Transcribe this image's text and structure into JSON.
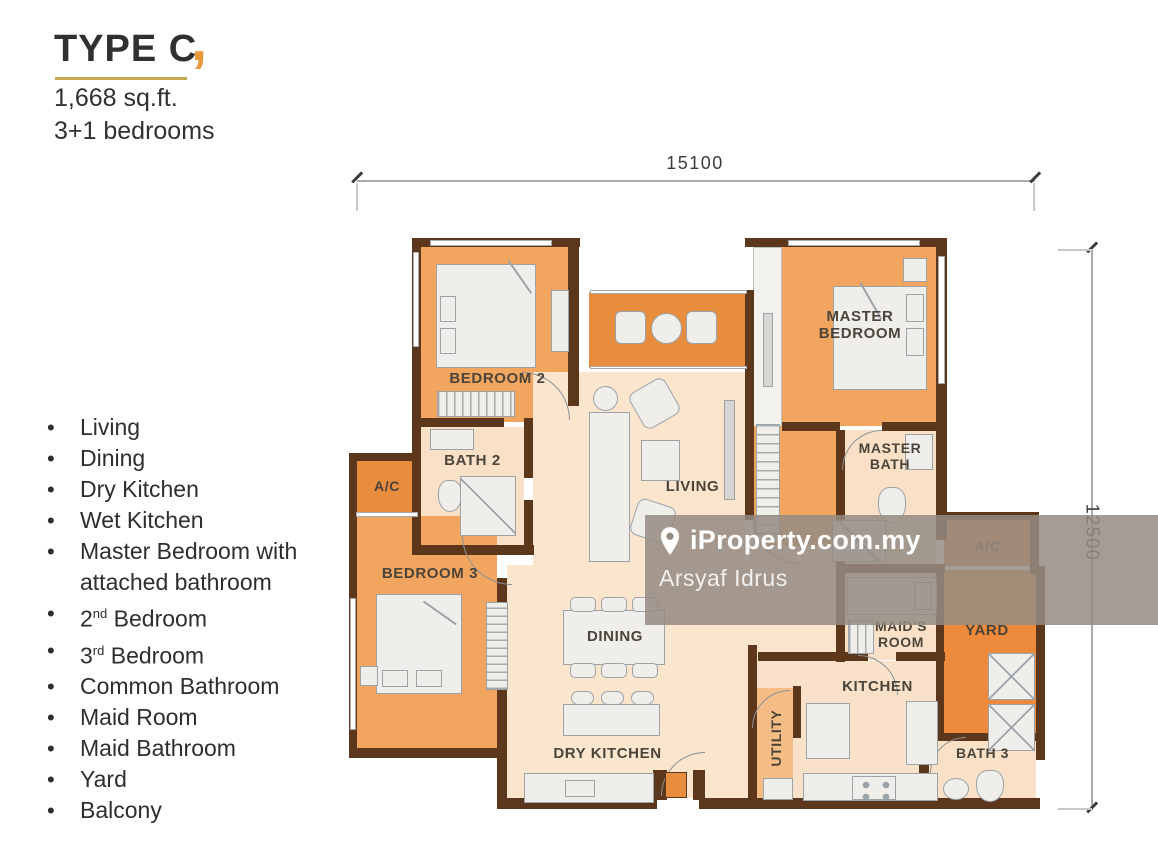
{
  "header": {
    "title": "TYPE C",
    "accent_mark": ",",
    "area": "1,668 sq.ft.",
    "bedrooms": "3+1 bedrooms"
  },
  "features": [
    {
      "pre": "Living"
    },
    {
      "pre": "Dining"
    },
    {
      "pre": "Dry Kitchen"
    },
    {
      "pre": "Wet Kitchen"
    },
    {
      "pre": "Master Bedroom with attached bathroom"
    },
    {
      "pre": "2",
      "sup": "nd",
      "post": " Bedroom"
    },
    {
      "pre": "3",
      "sup": "rd",
      "post": " Bedroom"
    },
    {
      "pre": "Common Bathroom"
    },
    {
      "pre": "Maid Room"
    },
    {
      "pre": "Maid Bathroom"
    },
    {
      "pre": "Yard"
    },
    {
      "pre": "Balcony"
    }
  ],
  "plan": {
    "labels": {
      "bedroom2": "BEDROOM 2",
      "bath2": "BATH 2",
      "ac_left": "A/C",
      "bedroom3": "BEDROOM 3",
      "living": "LIVING",
      "dining": "DINING",
      "dry_kitchen": "DRY KITCHEN",
      "master_bedroom": "MASTER BEDROOM",
      "master_bath": "MASTER BATH",
      "maids_room": "MAID'S ROOM",
      "yard": "YARD",
      "ac_right": "A/C",
      "kitchen": "KITCHEN",
      "utility": "UTILITY",
      "bath3": "BATH 3"
    },
    "dimensions": {
      "top": "15100",
      "right": "12500"
    }
  },
  "watermark": {
    "brand": "iProperty.com.my",
    "agent": "Arsyaf Idrus"
  },
  "colors": {
    "wall": "#5d371b",
    "room_orange": "#f2a55f",
    "accent_orange": "#e88c3e",
    "yard_orange": "#ee8a3b",
    "floor_light": "#fbe5cd",
    "bath_light": "#f9e0c7",
    "title_underline": "#c9a854",
    "accent_comma": "#e9993b",
    "watermark_band": "#948b82"
  }
}
